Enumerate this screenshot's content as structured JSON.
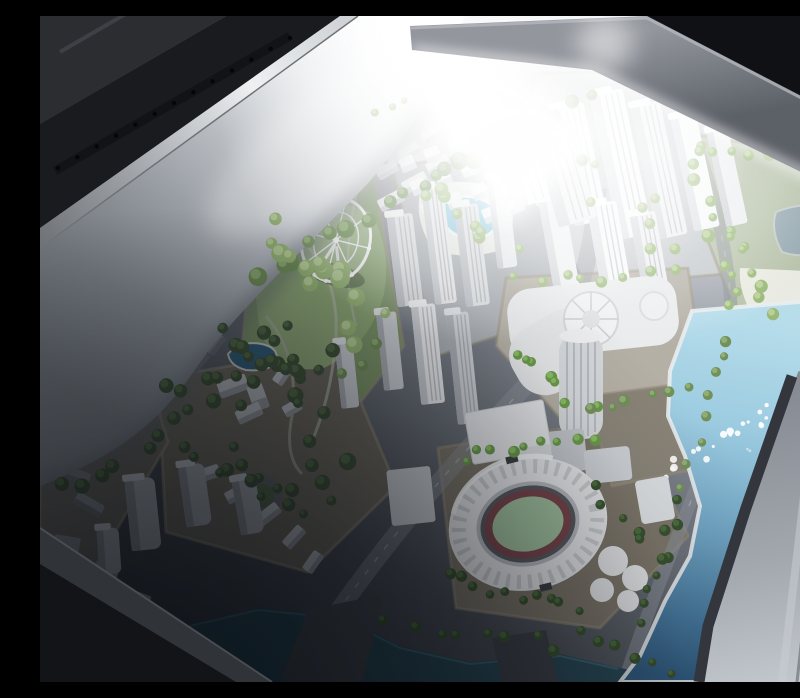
{
  "scene": {
    "description": "Photograph looking down into a glass display case containing an illuminated architectural scale model of a waterfront city: white skyscrapers, green model trees, a ferris wheel on a park hill, swimming pools, an oval stadium with a green pitch and dark red track, and a large light-blue bay with light reflections. A white side panel of the case fills the upper left; dark case rails and a gray beam cross the top.",
    "objects": [
      "display-case",
      "side-wall-panel",
      "perforated-rail",
      "top-beam",
      "city-model",
      "ferris-wheel",
      "park-hill",
      "swimming-pool",
      "pond",
      "skyscraper-cluster",
      "residential-rows",
      "convention-center",
      "cylindrical-tower",
      "stadium",
      "bay-water",
      "canal",
      "palm-trees",
      "roundabout",
      "case-rim"
    ],
    "colors": {
      "groundHi": "#c0c5cb",
      "groundMid": "#6e737b",
      "groundLo": "#383c42",
      "wallTop": "#ffffff",
      "wallMid": "#c9ced4",
      "wallLow": "#868c94",
      "rail": "#1a1b1e",
      "gloss": "#2b2d31",
      "metalHi": "#eef0f2",
      "metalLo": "#73767b",
      "beamHi": "#999ca3",
      "beamLo": "#5d6168",
      "topDark": "#0e0f11",
      "blockEdge": "#99907e",
      "parkGreen": "#7e966a",
      "hillHi": "#9db385",
      "hillLo": "#5a6f47",
      "sand": "#e9ebe2",
      "pondGray": "#97a9b1",
      "poolBlue": "#84c7de",
      "pondDark": "#35617e",
      "waterHi": "#b7ddeb",
      "waterLo": "#315c80",
      "canal": "#2a4a57",
      "rimBand": "#9aa0a8",
      "rimBandHi": "#c3c8ce",
      "rimLine": "#33373d",
      "stadiumShell": "#e8e9eb",
      "stadiumTrack": "#7a474d",
      "stadiumPitch": "#a2c29f",
      "roadHi": "#8d929a",
      "white": "#f7f8fa"
    },
    "tree_palettes": {
      "lit": [
        "#9ab878",
        "#bcd49c"
      ],
      "mid": [
        "#72905a",
        "#93b178"
      ],
      "dark": [
        "#41543a",
        "#57704a"
      ],
      "palm": [
        "#6b9a4c",
        "#8fc066"
      ],
      "palmdark": [
        "#3a5230",
        "#4f7040"
      ]
    },
    "tree_strips": [
      {
        "x1": 552,
        "y1": 78,
        "x2": 346,
        "y2": 188,
        "n": 14,
        "j": 8,
        "r0": 5,
        "r1": 9,
        "tone": "mid"
      },
      {
        "x1": 338,
        "y1": 196,
        "x2": 218,
        "y2": 262,
        "n": 8,
        "j": 10,
        "r0": 6,
        "r1": 10,
        "tone": "mid"
      },
      {
        "x1": 238,
        "y1": 206,
        "x2": 332,
        "y2": 318,
        "n": 14,
        "j": 26,
        "r0": 5,
        "r1": 10,
        "tone": "lit"
      },
      {
        "x1": 228,
        "y1": 310,
        "x2": 298,
        "y2": 452,
        "n": 12,
        "j": 20,
        "r0": 5,
        "r1": 9,
        "tone": "dark"
      },
      {
        "x1": 196,
        "y1": 386,
        "x2": 24,
        "y2": 468,
        "n": 10,
        "j": 12,
        "r0": 5,
        "r1": 8,
        "tone": "dark"
      },
      {
        "x1": 378,
        "y1": 168,
        "x2": 466,
        "y2": 228,
        "n": 8,
        "j": 14,
        "r0": 4,
        "r1": 7,
        "tone": "lit"
      },
      {
        "x1": 498,
        "y1": 122,
        "x2": 648,
        "y2": 238,
        "n": 10,
        "j": 26,
        "r0": 4,
        "r1": 7,
        "tone": "lit"
      },
      {
        "x1": 476,
        "y1": 268,
        "x2": 636,
        "y2": 258,
        "n": 8,
        "j": 8,
        "r0": 4,
        "r1": 6,
        "tone": "lit"
      },
      {
        "x1": 470,
        "y1": 330,
        "x2": 556,
        "y2": 398,
        "n": 8,
        "j": 10,
        "r0": 4,
        "r1": 6,
        "tone": "palm"
      },
      {
        "x1": 652,
        "y1": 128,
        "x2": 694,
        "y2": 298,
        "n": 10,
        "j": 10,
        "r0": 4,
        "r1": 7,
        "tone": "lit"
      },
      {
        "x1": 688,
        "y1": 318,
        "x2": 648,
        "y2": 470,
        "n": 8,
        "j": 8,
        "r0": 4,
        "r1": 6,
        "tone": "mid"
      },
      {
        "x1": 642,
        "y1": 486,
        "x2": 596,
        "y2": 606,
        "n": 8,
        "j": 6,
        "r0": 4,
        "r1": 6,
        "tone": "palmdark"
      },
      {
        "x1": 424,
        "y1": 442,
        "x2": 556,
        "y2": 424,
        "n": 9,
        "j": 8,
        "r0": 4,
        "r1": 6,
        "tone": "palm"
      },
      {
        "x1": 408,
        "y1": 560,
        "x2": 536,
        "y2": 598,
        "n": 10,
        "j": 8,
        "r0": 4,
        "r1": 6,
        "tone": "palmdark"
      },
      {
        "x1": 556,
        "y1": 470,
        "x2": 616,
        "y2": 540,
        "n": 6,
        "j": 8,
        "r0": 4,
        "r1": 6,
        "tone": "palmdark"
      },
      {
        "x1": 128,
        "y1": 372,
        "x2": 300,
        "y2": 344,
        "n": 10,
        "j": 10,
        "r0": 5,
        "r1": 8,
        "tone": "dark"
      },
      {
        "x1": 142,
        "y1": 436,
        "x2": 286,
        "y2": 478,
        "n": 9,
        "j": 16,
        "r0": 5,
        "r1": 8,
        "tone": "dark"
      },
      {
        "x1": 348,
        "y1": 606,
        "x2": 516,
        "y2": 630,
        "n": 8,
        "j": 7,
        "r0": 4,
        "r1": 6,
        "tone": "palmdark"
      },
      {
        "x1": 538,
        "y1": 618,
        "x2": 628,
        "y2": 652,
        "n": 6,
        "j": 6,
        "r0": 4,
        "r1": 6,
        "tone": "palmdark"
      },
      {
        "x1": 660,
        "y1": 136,
        "x2": 786,
        "y2": 152,
        "n": 8,
        "j": 8,
        "r0": 4,
        "r1": 7,
        "tone": "lit"
      },
      {
        "x1": 684,
        "y1": 206,
        "x2": 728,
        "y2": 290,
        "n": 8,
        "j": 10,
        "r0": 4,
        "r1": 7,
        "tone": "lit"
      },
      {
        "x1": 552,
        "y1": 388,
        "x2": 644,
        "y2": 376,
        "n": 6,
        "j": 6,
        "r0": 4,
        "r1": 6,
        "tone": "mid"
      },
      {
        "x1": 178,
        "y1": 318,
        "x2": 252,
        "y2": 356,
        "n": 7,
        "j": 8,
        "r0": 5,
        "r1": 8,
        "tone": "dark"
      },
      {
        "x1": 330,
        "y1": 96,
        "x2": 466,
        "y2": 72,
        "n": 8,
        "j": 6,
        "r0": 3,
        "r1": 5,
        "tone": "lit"
      },
      {
        "x1": 748,
        "y1": 96,
        "x2": 798,
        "y2": 140,
        "n": 5,
        "j": 8,
        "r0": 4,
        "r1": 6,
        "tone": "lit"
      },
      {
        "x1": 188,
        "y1": 452,
        "x2": 262,
        "y2": 502,
        "n": 6,
        "j": 10,
        "r0": 4,
        "r1": 7,
        "tone": "dark"
      },
      {
        "x1": 306,
        "y1": 360,
        "x2": 334,
        "y2": 332,
        "n": 3,
        "j": 6,
        "r0": 4,
        "r1": 6,
        "tone": "mid"
      }
    ],
    "sparkle_strips": [
      {
        "x1": 626,
        "y1": 454,
        "x2": 738,
        "y2": 396,
        "n": 20,
        "j": 12,
        "r0": 1.5,
        "r1": 4,
        "o": 0.9
      },
      {
        "x1": 700,
        "y1": 434,
        "x2": 772,
        "y2": 414,
        "n": 8,
        "j": 8,
        "r0": 1,
        "r1": 2.5,
        "o": 0.5
      }
    ],
    "rail_holes": {
      "x1": 250,
      "y1": 22,
      "x2": 18,
      "y2": 152,
      "n": 13,
      "r": 2.2
    },
    "tower_fills": {
      "bw": [
        "#f6f8f9",
        "#dadde0",
        "#ffffff"
      ],
      "bw2": [
        "#eceef0",
        "#cfd3d6",
        "#fafbfc"
      ],
      "tw1": [
        "#dde0e3",
        "#bcc0c5",
        "#f2f4f5"
      ],
      "tw2": [
        "#e8eaec",
        "#c6cacf",
        "#f6f7f8"
      ],
      "tw3": [
        "#cdd1d5",
        "#aaaeb4",
        "#e4e6e9"
      ],
      "gray": [
        "#a8acb2",
        "#8b8f95",
        "#c2c6cb"
      ]
    },
    "towers": [
      {
        "x": 352,
        "y": 198,
        "w": 26,
        "h": 92,
        "rot": -7,
        "f": "tw1",
        "rib": 1
      },
      {
        "x": 388,
        "y": 170,
        "w": 22,
        "h": 118,
        "rot": -7,
        "f": "tw2",
        "rib": 1
      },
      {
        "x": 420,
        "y": 188,
        "w": 24,
        "h": 102,
        "rot": -7,
        "f": "tw1",
        "rib": 1
      },
      {
        "x": 452,
        "y": 160,
        "w": 20,
        "h": 92,
        "rot": -7,
        "f": "tw2",
        "rib": 0
      },
      {
        "x": 340,
        "y": 296,
        "w": 20,
        "h": 78,
        "rot": -6,
        "f": "tw3",
        "rib": 0
      },
      {
        "x": 376,
        "y": 288,
        "w": 24,
        "h": 100,
        "rot": -6,
        "f": "tw2",
        "rib": 1
      },
      {
        "x": 412,
        "y": 296,
        "w": 22,
        "h": 112,
        "rot": -6,
        "f": "tw3",
        "rib": 1
      },
      {
        "x": 298,
        "y": 326,
        "w": 18,
        "h": 66,
        "rot": -6,
        "f": "tw3",
        "rib": 0
      },
      {
        "x": 522,
        "y": 88,
        "w": 34,
        "h": 120,
        "rot": -12,
        "f": "bw",
        "rib": 1
      },
      {
        "x": 564,
        "y": 74,
        "w": 34,
        "h": 148,
        "rot": -12,
        "f": "bw",
        "rib": 1
      },
      {
        "x": 604,
        "y": 86,
        "w": 30,
        "h": 136,
        "rot": -12,
        "f": "bw2",
        "rib": 1
      },
      {
        "x": 642,
        "y": 98,
        "w": 26,
        "h": 116,
        "rot": -12,
        "f": "bw",
        "rib": 0
      },
      {
        "x": 676,
        "y": 112,
        "w": 22,
        "h": 98,
        "rot": -12,
        "f": "bw2",
        "rib": 0
      },
      {
        "x": 506,
        "y": 182,
        "w": 26,
        "h": 92,
        "rot": -10,
        "f": "bw2",
        "rib": 0
      },
      {
        "x": 556,
        "y": 186,
        "w": 30,
        "h": 112,
        "rot": -10,
        "f": "bw",
        "rib": 1
      },
      {
        "x": 600,
        "y": 196,
        "w": 26,
        "h": 124,
        "rot": -10,
        "f": "bw2",
        "rib": 1
      },
      {
        "x": 462,
        "y": 96,
        "w": 46,
        "h": 92,
        "rot": -16,
        "f": "bw",
        "rib": 1
      },
      {
        "x": 506,
        "y": 120,
        "w": 40,
        "h": 88,
        "rot": -16,
        "f": "bw2",
        "rib": 1
      },
      {
        "x": 88,
        "y": 462,
        "w": 30,
        "h": 72,
        "rot": -6,
        "f": "gray",
        "rib": 0,
        "rx": 7
      },
      {
        "x": 142,
        "y": 448,
        "w": 26,
        "h": 62,
        "rot": -8,
        "f": "gray",
        "rib": 0,
        "rx": 7
      },
      {
        "x": 196,
        "y": 462,
        "w": 24,
        "h": 56,
        "rot": -10,
        "f": "gray",
        "rib": 0,
        "rx": 7
      },
      {
        "x": 58,
        "y": 512,
        "w": 22,
        "h": 46,
        "rot": -4,
        "f": "gray",
        "rib": 0,
        "rx": 6
      }
    ],
    "slab_fills": {
      "rowlit": [
        "#e6e8ea",
        "#c8ccd0"
      ],
      "rowmid": [
        "#b9bdc2",
        "#969aa0"
      ],
      "rowdark": [
        "#898d93",
        "#6c7076"
      ]
    },
    "slabs": [
      {
        "x": 66,
        "y": 418,
        "w": 24,
        "h": 12,
        "rot": -42,
        "f": "rowdark"
      },
      {
        "x": 86,
        "y": 398,
        "w": 24,
        "h": 12,
        "rot": -44,
        "f": "rowdark"
      },
      {
        "x": 106,
        "y": 378,
        "w": 24,
        "h": 12,
        "rot": -46,
        "f": "rowdark"
      },
      {
        "x": 126,
        "y": 358,
        "w": 24,
        "h": 12,
        "rot": -48,
        "f": "rowdark"
      },
      {
        "x": 146,
        "y": 340,
        "w": 24,
        "h": 12,
        "rot": -50,
        "f": "rowdark"
      },
      {
        "x": 164,
        "y": 322,
        "w": 22,
        "h": 12,
        "rot": -52,
        "f": "rowdark"
      },
      {
        "x": 178,
        "y": 362,
        "w": 30,
        "h": 16,
        "rot": -20,
        "f": "rowmid"
      },
      {
        "x": 210,
        "y": 368,
        "w": 16,
        "h": 26,
        "rot": -20,
        "f": "rowmid"
      },
      {
        "x": 196,
        "y": 390,
        "w": 26,
        "h": 14,
        "rot": -25,
        "f": "rowmid"
      },
      {
        "x": 232,
        "y": 352,
        "w": 22,
        "h": 12,
        "rot": -55,
        "f": "rowmid"
      },
      {
        "x": 243,
        "y": 386,
        "w": 18,
        "h": 12,
        "rot": -30,
        "f": "rowmid"
      },
      {
        "x": 150,
        "y": 452,
        "w": 30,
        "h": 13,
        "rot": -18,
        "f": "rowmid"
      },
      {
        "x": 185,
        "y": 470,
        "w": 28,
        "h": 13,
        "rot": -28,
        "f": "rowmid"
      },
      {
        "x": 215,
        "y": 492,
        "w": 26,
        "h": 13,
        "rot": -38,
        "f": "rowmid"
      },
      {
        "x": 242,
        "y": 515,
        "w": 24,
        "h": 12,
        "rot": -48,
        "f": "rowmid"
      },
      {
        "x": 262,
        "y": 540,
        "w": 22,
        "h": 12,
        "rot": -55,
        "f": "rowmid"
      },
      {
        "x": 8,
        "y": 392,
        "w": 36,
        "h": 14,
        "rot": 8,
        "f": "rowdark"
      },
      {
        "x": 4,
        "y": 424,
        "w": 32,
        "h": 13,
        "rot": 14,
        "f": "rowdark"
      },
      {
        "x": 16,
        "y": 452,
        "w": 34,
        "h": 13,
        "rot": 20,
        "f": "rowdark"
      },
      {
        "x": 34,
        "y": 482,
        "w": 30,
        "h": 13,
        "rot": 30,
        "f": "rowdark"
      },
      {
        "x": 12,
        "y": 520,
        "w": 26,
        "h": 36,
        "rot": 10,
        "f": "rowdark"
      },
      {
        "x": 52,
        "y": 548,
        "w": 24,
        "h": 30,
        "rot": 16,
        "f": "rowdark"
      },
      {
        "x": 86,
        "y": 576,
        "w": 22,
        "h": 26,
        "rot": 20,
        "f": "rowdark"
      },
      {
        "x": 338,
        "y": 178,
        "w": 26,
        "h": 13,
        "rot": -28,
        "f": "rowlit"
      },
      {
        "x": 362,
        "y": 160,
        "w": 26,
        "h": 13,
        "rot": -28,
        "f": "rowlit"
      },
      {
        "x": 386,
        "y": 142,
        "w": 24,
        "h": 12,
        "rot": -28,
        "f": "rowlit"
      },
      {
        "x": 410,
        "y": 124,
        "w": 24,
        "h": 12,
        "rot": -28,
        "f": "rowlit"
      },
      {
        "x": 336,
        "y": 148,
        "w": 22,
        "h": 12,
        "rot": -30,
        "f": "rowlit"
      },
      {
        "x": 358,
        "y": 130,
        "w": 22,
        "h": 12,
        "rot": -30,
        "f": "rowlit"
      },
      {
        "x": 382,
        "y": 112,
        "w": 20,
        "h": 12,
        "rot": -30,
        "f": "rowlit"
      },
      {
        "x": 750,
        "y": 100,
        "w": 16,
        "h": 12,
        "rot": -18,
        "f": "rowlit"
      },
      {
        "x": 770,
        "y": 112,
        "w": 16,
        "h": 12,
        "rot": -18,
        "f": "rowlit"
      },
      {
        "x": 758,
        "y": 128,
        "w": 16,
        "h": 12,
        "rot": -18,
        "f": "rowlit"
      }
    ],
    "cube_grid": {
      "x0": 360,
      "y0": 140,
      "cols": 5,
      "rows": 4,
      "cdx": 25,
      "cdy": -9,
      "rdx": 11,
      "rdy": 23,
      "s": 15,
      "rot": -22,
      "fill": "#f3f5f6",
      "side": "#d9dcdf"
    }
  }
}
